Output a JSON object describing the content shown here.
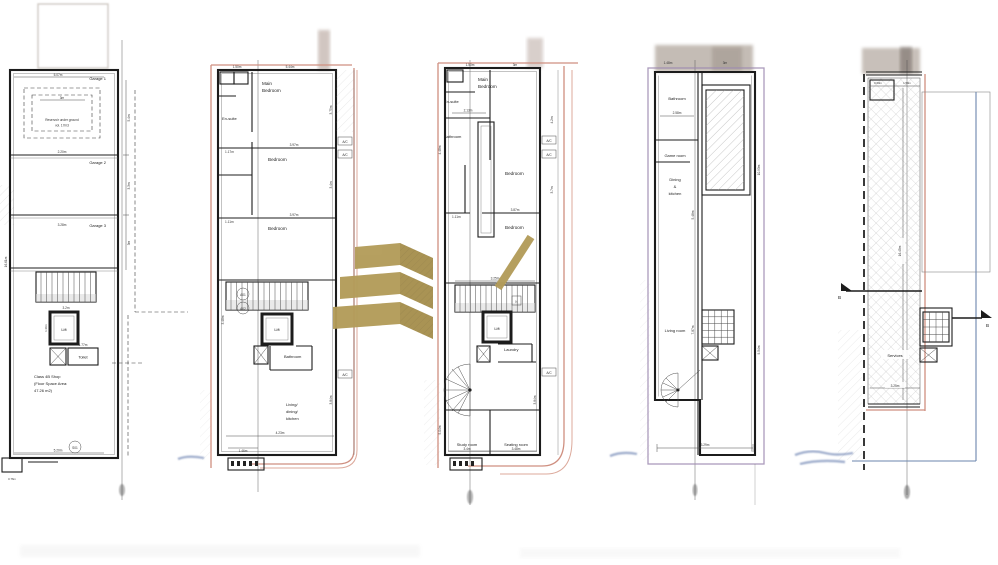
{
  "document": {
    "type": "architectural-floor-plans",
    "sheets": 5
  },
  "colors": {
    "gold": "#b39c59",
    "gold_dark": "#a68f4e",
    "wall": "#1c1c1c",
    "pink_boundary": "#cf8f80",
    "purple_boundary": "#9d8bb0",
    "blue_boundary": "#6b86ad"
  },
  "plans": [
    {
      "name": "ground-floor",
      "badge": "S01",
      "rooms": {
        "garage1": "Garage 1",
        "garage2": "Garage 2",
        "garage3": "Garage 3",
        "reservoir1": "Reservoir under ground",
        "reservoir2": "vol. 17m3",
        "lift": "Lift",
        "toilet": "Toilet",
        "shop1": "Class 4B Shop",
        "shop2": "(Floor Space Area:",
        "shop3": "47.26 m2)"
      },
      "dims": {
        "top": "5.07m",
        "res": "3m",
        "g2": "2.20m",
        "g3": "3.28m",
        "left": "16.61m",
        "r1": "5.4m",
        "r2": "3.3m",
        "r3": "3m",
        "lift": "1.36m",
        "toilet": "1.77m",
        "stair": "3.2m",
        "bottom": "5.20m",
        "step": "0.76m"
      }
    },
    {
      "name": "first-floor",
      "rooms": {
        "main1": "Main",
        "main2": "Bedroom",
        "ensuite": "En-suite",
        "bed2": "Bedroom",
        "bed3": "Bedroom",
        "ac1": "A/C",
        "ac2": "A/C",
        "ac3": "A/C",
        "a01": "A01",
        "a02": "A02",
        "lift": "Lift",
        "bath": "Bathroom",
        "liv1": "Living/",
        "liv2": "dining/",
        "liv3": "kitchen"
      },
      "dims": {
        "t1": "1.50m",
        "t2": "5.44m",
        "r1": "3.75m",
        "r2": "3.4m",
        "m1": "1.17m",
        "m2": "3.97m",
        "m3": "1.11m",
        "m4": "3.97m",
        "l1": "3.48m",
        "b1": "4.23m",
        "b2": "1.46m",
        "r3": "3.84m"
      }
    },
    {
      "name": "second-floor",
      "rooms": {
        "main1": "Main",
        "main2": "Bedroom",
        "ensuite": "En-suite",
        "bath": "Bathroom",
        "bed2": "Bedroom",
        "bed3": "Bedroom",
        "ac1": "A/C",
        "ac2": "A/C",
        "ac3": "A/C",
        "lift": "Lift",
        "laundry": "Laundry",
        "n": "N",
        "study": "Study room",
        "seating": "Seating room"
      },
      "dims": {
        "t1": "1.50m",
        "t2": "3m",
        "bathw": "2.13m",
        "m1": "1.11m",
        "m2": "3.87m",
        "r1": "4.2m",
        "r2": "3.7m",
        "stair": "3.25m",
        "l1": "4.48m",
        "l2": "5.04m",
        "b1": "3.4m",
        "b2": "3.48m",
        "r3": "3.84m"
      }
    },
    {
      "name": "third-floor",
      "rooms": {
        "bath": "Bathroom",
        "game": "Game room",
        "din1": "Dining",
        "din2": "&",
        "din3": "kitchen",
        "living": "Living room"
      },
      "dims": {
        "bathw": "2.58m",
        "t1": "1.48m",
        "t2": "3m",
        "r1": "10.93m",
        "r2": "9.54m",
        "c1": "5.48m",
        "c2": "7.87m",
        "b1": "3.29m"
      }
    },
    {
      "name": "roof",
      "rooms": {
        "services": "Services"
      },
      "markers": {
        "b_left": "B",
        "b_right": "B"
      },
      "dims": {
        "t1": "0.60m",
        "t2": "1.59m",
        "mid": "16.45m",
        "b1": "3.25m"
      }
    }
  ]
}
